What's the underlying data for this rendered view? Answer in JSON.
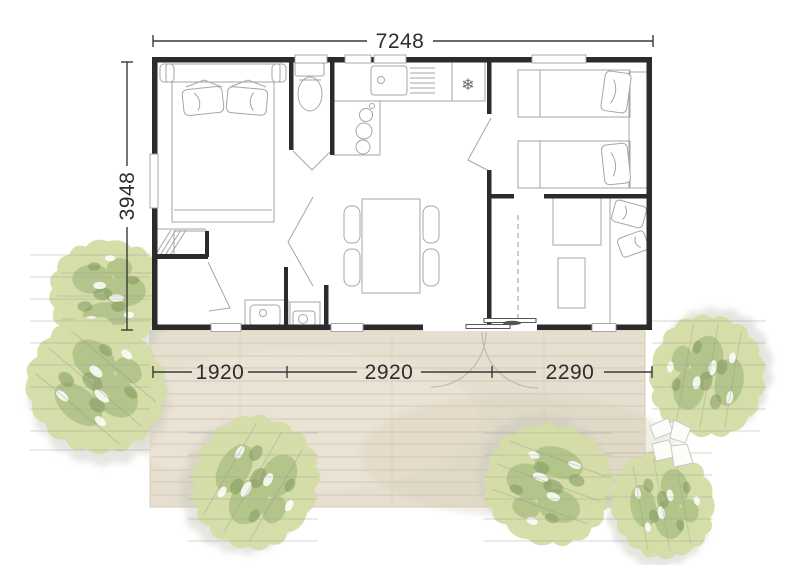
{
  "plan": {
    "dimensions": {
      "width": {
        "label": "7248"
      },
      "height": {
        "label": "3948"
      },
      "bottom_segments": [
        {
          "label": "1920"
        },
        {
          "label": "2920"
        },
        {
          "label": "2290"
        }
      ]
    },
    "icons": {
      "fridge_snowflake": "❄"
    },
    "colors": {
      "wall": "#2b2b2b",
      "dimension": "#2d2d2d",
      "furniture_line": "#a6a6a6",
      "deck": "#e6dfd0",
      "deck_plank": "#cfc6b2",
      "tree_light": "#d4dda7",
      "tree_mid": "#a9be81",
      "tree_dark": "#829b5f"
    }
  }
}
